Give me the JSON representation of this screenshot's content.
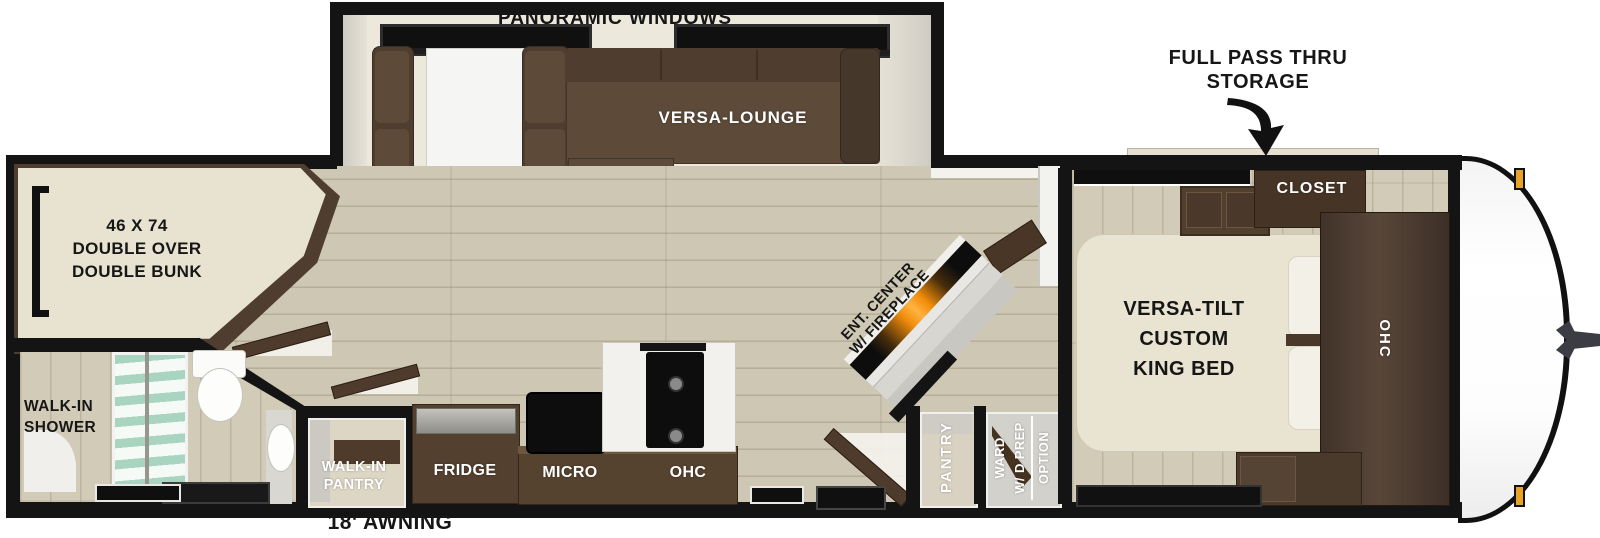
{
  "floorplan": {
    "exterior": {
      "storage_label_line1": "FULL PASS THRU",
      "storage_label_line2": "STORAGE",
      "awning_label": "18' AWNING"
    },
    "slideout": {
      "windows_label": "PANORAMIC WINDOWS",
      "lounge_label": "VERSA-LOUNGE"
    },
    "bunk_room": {
      "lines": [
        "46 X 74",
        "DOUBLE OVER",
        "DOUBLE BUNK"
      ]
    },
    "bathroom": {
      "shower_lines": [
        "WALK-IN",
        "SHOWER"
      ]
    },
    "walkin_pantry": {
      "lines": [
        "WALK-IN",
        "PANTRY"
      ]
    },
    "kitchen": {
      "fridge_label": "FRIDGE",
      "micro_label": "MICRO",
      "ohc_label": "OHC"
    },
    "hall": {
      "ent_center_lines": [
        "ENT. CENTER",
        "W/ FIREPLACE"
      ],
      "pantry_label": "PANTRY",
      "ward_lines": [
        "WARD",
        "W/ D PREP",
        "OPTION"
      ]
    },
    "bedroom": {
      "closet_label": "CLOSET",
      "bed_lines": [
        "VERSA-TILT",
        "CUSTOM",
        "KING BED"
      ],
      "ohc_label": "OHC"
    },
    "colors": {
      "wall": "#141414",
      "sofa_brown": "#5d4a38",
      "cabinet_brown": "#4f3b2b",
      "mattress_cream": "#e8e3d1",
      "floor_tan": "#cec7b3",
      "fireplace_orange": "#f08c0a",
      "marker_amber": "#e8a225",
      "glass_teal": "#b4dac6"
    }
  }
}
